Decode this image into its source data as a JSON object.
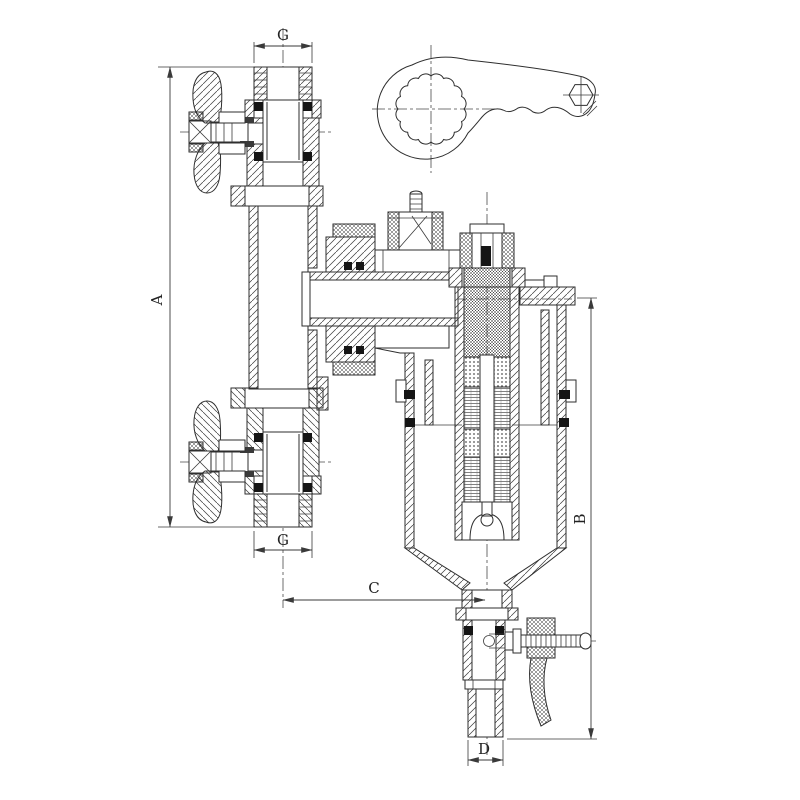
{
  "canvas": {
    "width": 800,
    "height": 800,
    "background": "#ffffff",
    "line_color": "#2e2e2e",
    "seal_color": "#151515"
  },
  "drawing_type": "technical-cross-section",
  "labels": {
    "dim_g_top": "G",
    "dim_a": "A",
    "dim_g_bottom": "G",
    "dim_c": "C",
    "dim_b": "B",
    "dim_d": "D"
  },
  "parts": [
    "ring-spanner-wrench",
    "top-ball-valve",
    "bottom-ball-valve",
    "vertical-pipe",
    "tee-union",
    "air-vent-plug",
    "filter-cap",
    "filter-head",
    "magnet-cartridge",
    "filter-bowl",
    "drain-valve",
    "drain-lever-handle"
  ]
}
